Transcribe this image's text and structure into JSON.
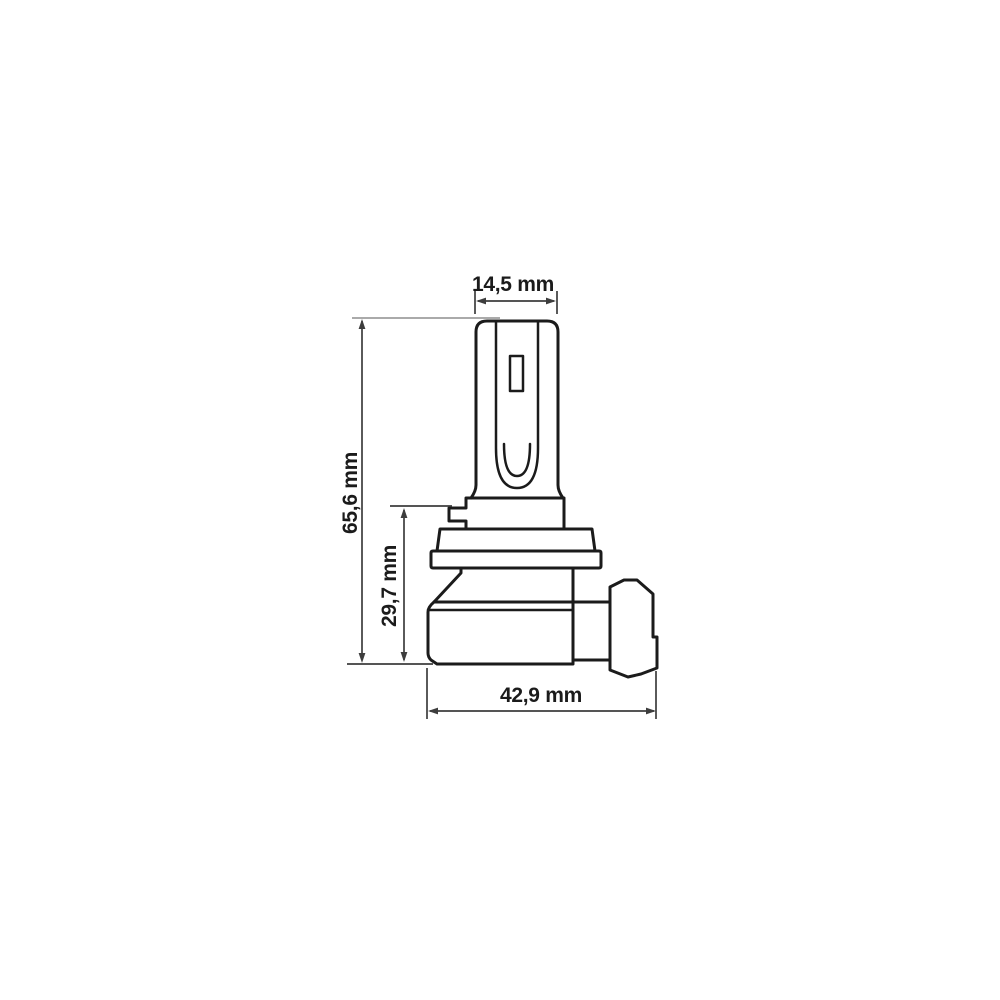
{
  "page": {
    "background": "#ffffff"
  },
  "diagram": {
    "kind": "technical-dimension-drawing",
    "outline_color": "#1b1b1b",
    "dimension_color": "#3d3d3d",
    "extension_color": "#8e8e8e",
    "label_color": "#1b1b1b",
    "dimensions": {
      "head_width": {
        "label": "14,5 mm",
        "value_mm": 14.5,
        "orientation": "horizontal"
      },
      "total_height": {
        "label": "65,6 mm",
        "value_mm": 65.6,
        "orientation": "vertical"
      },
      "base_height": {
        "label": "29,7 mm",
        "value_mm": 29.7,
        "orientation": "vertical"
      },
      "base_length": {
        "label": "42,9 mm",
        "value_mm": 42.9,
        "orientation": "horizontal"
      }
    }
  }
}
